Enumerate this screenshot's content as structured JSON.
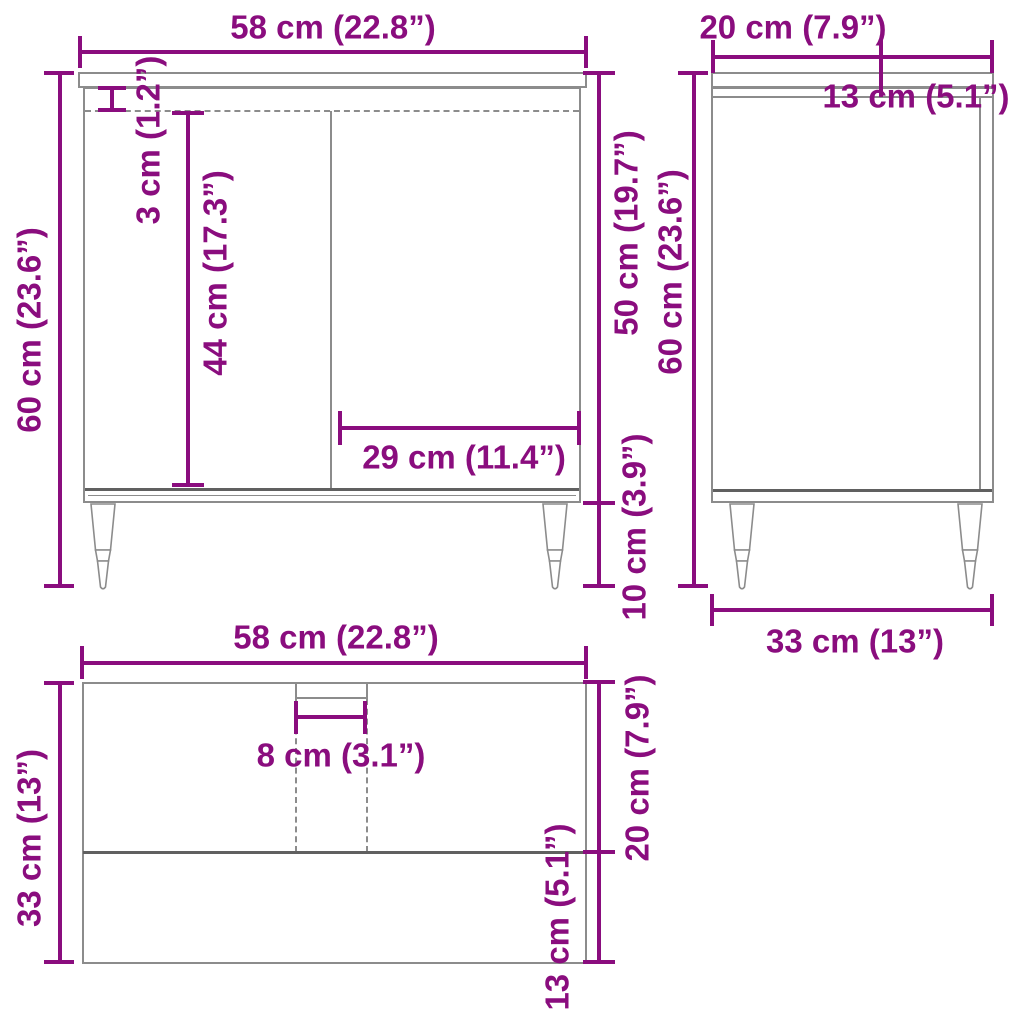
{
  "title": "Cabinet dimension diagram",
  "colors": {
    "dimension": "#8A0D7E",
    "drawing": "#8C8C8C",
    "drawing_dark": "#606060",
    "background": "#FFFFFF"
  },
  "views": {
    "front": {
      "name": "front-view",
      "labels": {
        "width": "58 cm (22.8”)",
        "height": "60 cm (23.6”)",
        "top_rail": "3 cm (1.2”)",
        "door_height": "44 cm (17.3”)",
        "right_door_width": "29 cm (11.4”)",
        "body_height": "50 cm (19.7”)",
        "leg_height": "10 cm (3.9”)"
      }
    },
    "side": {
      "name": "side-view",
      "labels": {
        "top_depth": "20 cm (7.9”)",
        "top_back_depth": "13 cm (5.1”)",
        "height": "60 cm (23.6”)",
        "base_depth": "33 cm (13”)"
      }
    },
    "top": {
      "name": "top-view",
      "labels": {
        "width": "58 cm (22.8”)",
        "depth": "33 cm (13”)",
        "notch_width": "8 cm (3.1”)",
        "front_depth": "20 cm (7.9”)",
        "back_depth": "13 cm (5.1”)"
      }
    }
  }
}
